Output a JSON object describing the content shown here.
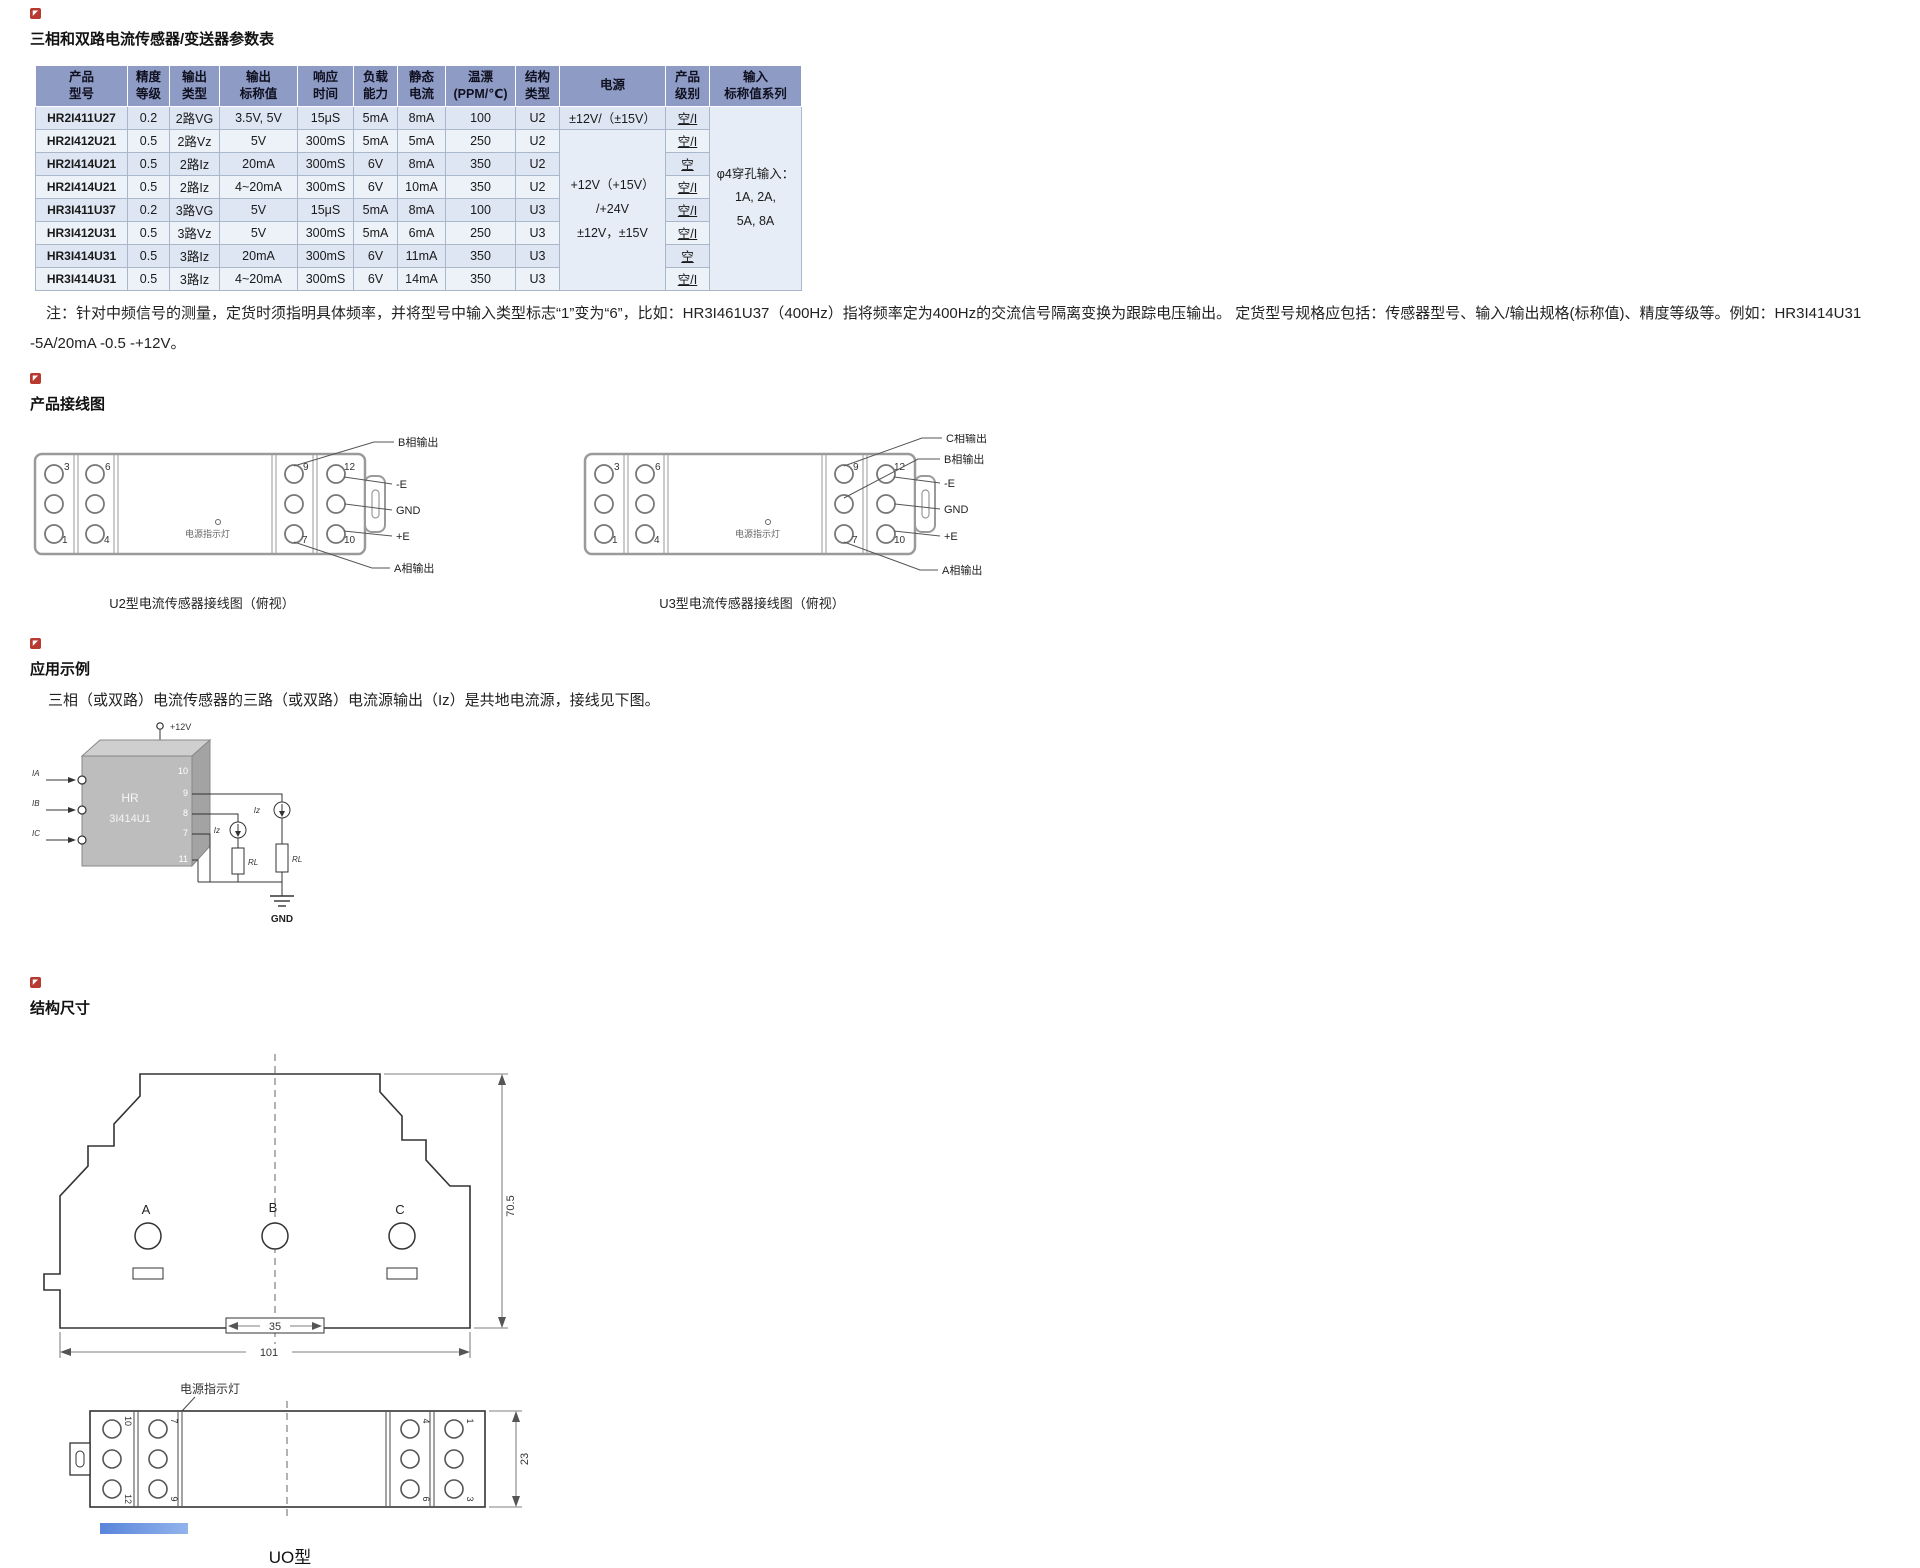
{
  "page": {
    "title": "三相和双路电流传感器/变送器参数表"
  },
  "table": {
    "headers": [
      "产品\n型号",
      "精度\n等级",
      "输出\n类型",
      "输出\n标称值",
      "响应\n时间",
      "负载\n能力",
      "静态\n电流",
      "温漂\n(PPM/℃)",
      "结构\n类型",
      "电源",
      "产品\n级别",
      "输入\n标称值系列"
    ],
    "rows": [
      {
        "model": "HR2I411U27",
        "acc": "0.2",
        "otype": "2路VG",
        "nominal": "3.5V, 5V",
        "resp": "15μS",
        "load": "5mA",
        "iq": "8mA",
        "drift": "100",
        "struct": "U2",
        "level": "空/I"
      },
      {
        "model": "HR2I412U21",
        "acc": "0.5",
        "otype": "2路Vz",
        "nominal": "5V",
        "resp": "300mS",
        "load": "5mA",
        "iq": "5mA",
        "drift": "250",
        "struct": "U2",
        "level": "空/I"
      },
      {
        "model": "HR2I414U21",
        "acc": "0.5",
        "otype": "2路Iz",
        "nominal": "20mA",
        "resp": "300mS",
        "load": "6V",
        "iq": "8mA",
        "drift": "350",
        "struct": "U2",
        "level": "空"
      },
      {
        "model": "HR2I414U21",
        "acc": "0.5",
        "otype": "2路Iz",
        "nominal": "4~20mA",
        "resp": "300mS",
        "load": "6V",
        "iq": "10mA",
        "drift": "350",
        "struct": "U2",
        "level": "空/I"
      },
      {
        "model": "HR3I411U37",
        "acc": "0.2",
        "otype": "3路VG",
        "nominal": "5V",
        "resp": "15μS",
        "load": "5mA",
        "iq": "8mA",
        "drift": "100",
        "struct": "U3",
        "level": "空/I"
      },
      {
        "model": "HR3I412U31",
        "acc": "0.5",
        "otype": "3路Vz",
        "nominal": "5V",
        "resp": "300mS",
        "load": "5mA",
        "iq": "6mA",
        "drift": "250",
        "struct": "U3",
        "level": "空/I"
      },
      {
        "model": "HR3I414U31",
        "acc": "0.5",
        "otype": "3路Iz",
        "nominal": "20mA",
        "resp": "300mS",
        "load": "6V",
        "iq": "11mA",
        "drift": "350",
        "struct": "U3",
        "level": "空"
      },
      {
        "model": "HR3I414U31",
        "acc": "0.5",
        "otype": "3路Iz",
        "nominal": "4~20mA",
        "resp": "300mS",
        "load": "6V",
        "iq": "14mA",
        "drift": "350",
        "struct": "U3",
        "level": "空/I"
      }
    ],
    "power_row1": "±12V/（±15V）",
    "power_rest": "+12V（+15V）\n/+24V\n±12V，±15V",
    "input_series": "φ4穿孔输入：\n1A, 2A,\n5A, 8A"
  },
  "note": {
    "text": "注：针对中频信号的测量，定货时须指明具体频率，并将型号中输入类型标志“1”变为“6”，比如：HR3I461U37（400Hz）指将频率定为400Hz的交流信号隔离变换为跟踪电压输出。 定货型号规格应包括：传感器型号、输入/输出规格(标称值)、精度等级等。例如：HR3I414U31 -5A/20mA -0.5 -+12V。"
  },
  "wiring": {
    "heading": "产品接线图",
    "indicator": "电源指示灯",
    "terminals": {
      "t3": "3",
      "t6": "6",
      "t1": "1",
      "t4": "4",
      "t9": "9",
      "t12": "12",
      "t7": "7",
      "t10": "10"
    },
    "u2": {
      "caption": "U2型电流传感器接线图（俯视）",
      "labels": [
        "B相输出",
        "-E",
        "GND",
        "+E",
        "A相输出"
      ]
    },
    "u3": {
      "caption": "U3型电流传感器接线图（俯视）",
      "labels": [
        "C相输出",
        "B相输出",
        "-E",
        "GND",
        "+E",
        "A相输出"
      ]
    }
  },
  "application": {
    "heading": "应用示例",
    "description": "三相（或双路）电流传感器的三路（或双路）电流源输出（Iz）是共地电流源，接线见下图。",
    "circuit": {
      "supply": "+12V",
      "gnd": "GND",
      "chip_line1": "HR",
      "chip_line2": "3I414U1",
      "pins": [
        "10",
        "9",
        "8",
        "7",
        "11"
      ],
      "inputs": [
        "IA",
        "IB",
        "IC"
      ],
      "iz": "Iz",
      "rl": "RL"
    }
  },
  "dimensions": {
    "heading": "结构尺寸",
    "indicator": "电源指示灯",
    "front": {
      "holes": [
        "A",
        "B",
        "C"
      ],
      "height": "70.5",
      "inner_width": "35",
      "total_width": "101"
    },
    "top": {
      "depth": "23",
      "caption": "UO型",
      "left_terminals": [
        "10",
        "7",
        "12",
        "9"
      ],
      "right_terminals": [
        "4",
        "1",
        "6",
        "3"
      ]
    }
  }
}
